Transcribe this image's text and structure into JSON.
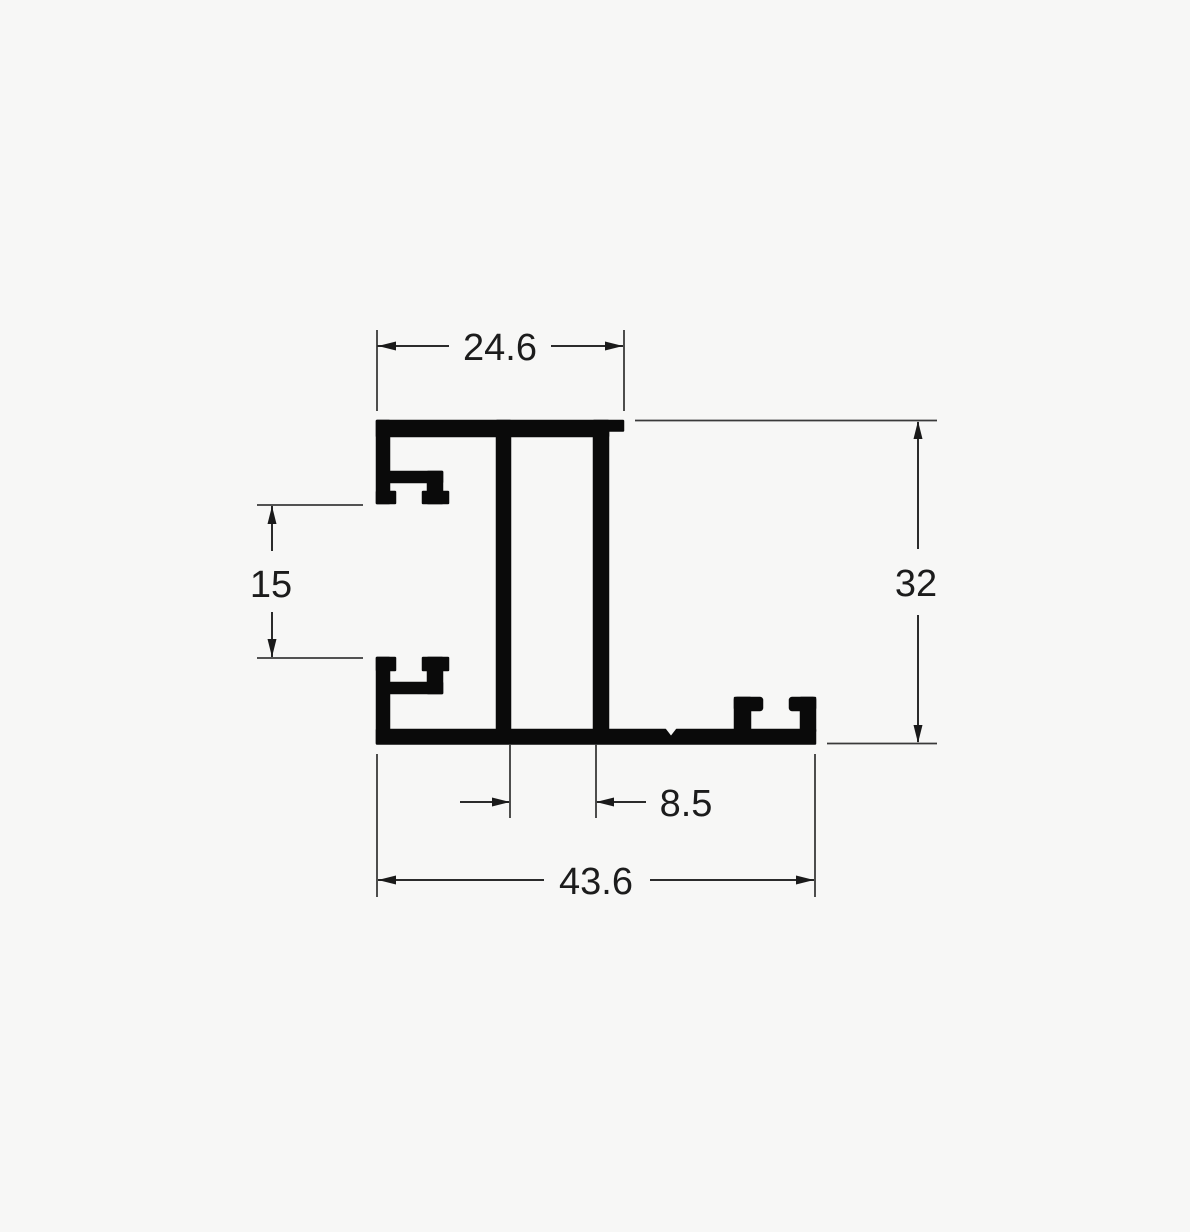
{
  "diagram": {
    "type": "technical-drawing",
    "subject": "extruded-profile-cross-section",
    "colors": {
      "background": "#f7f7f6",
      "profile_ink": "#0a0a0a",
      "dimension_line": "#2b2b2b",
      "label_text": "#1c1c1c"
    },
    "dimensions": {
      "top_width": {
        "label": "24.6",
        "orientation": "horizontal",
        "position": "top"
      },
      "groove_gap": {
        "label": "15",
        "orientation": "vertical",
        "position": "left"
      },
      "height": {
        "label": "32",
        "orientation": "vertical",
        "position": "right"
      },
      "web_gap": {
        "label": "8.5",
        "orientation": "horizontal",
        "position": "bottom-inner"
      },
      "total_width": {
        "label": "43.6",
        "orientation": "horizontal",
        "position": "bottom"
      }
    }
  }
}
